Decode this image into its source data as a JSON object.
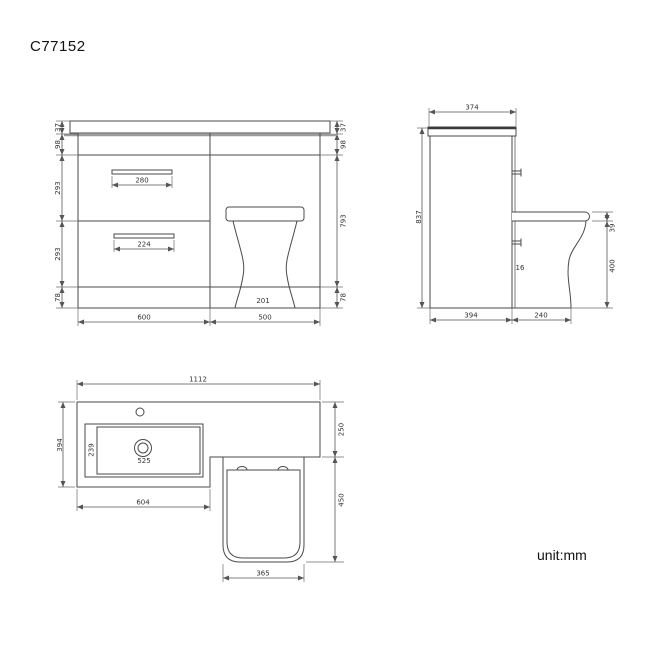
{
  "title": "C77152",
  "unit_label": "unit:mm",
  "colors": {
    "line": "#4a4a4a",
    "worktop_edge_gray": "#9c9c9c",
    "text": "#333333"
  },
  "front_view": {
    "left_dims": [
      "37",
      "98",
      "293",
      "293",
      "78"
    ],
    "right_dims": [
      "37",
      "98",
      "793",
      "78"
    ],
    "bottom_dims": [
      "600",
      "500"
    ],
    "top_handle_width": "280",
    "bottom_handle_width": "224",
    "toilet_base_width": "201"
  },
  "side_view": {
    "top_depth": "374",
    "overall_height": "837",
    "cabinet_depth": "394",
    "toilet_projection": "240",
    "seat_thickness": "39",
    "pan_height": "400",
    "gap": "16"
  },
  "plan_view": {
    "overall_width": "1112",
    "worktop_depth": "394",
    "vanity_width": "604",
    "basin_inner_width": "525",
    "basin_inner_depth": "239",
    "wc_counter_depth": "250",
    "pan_length": "450",
    "seat_width": "365"
  }
}
